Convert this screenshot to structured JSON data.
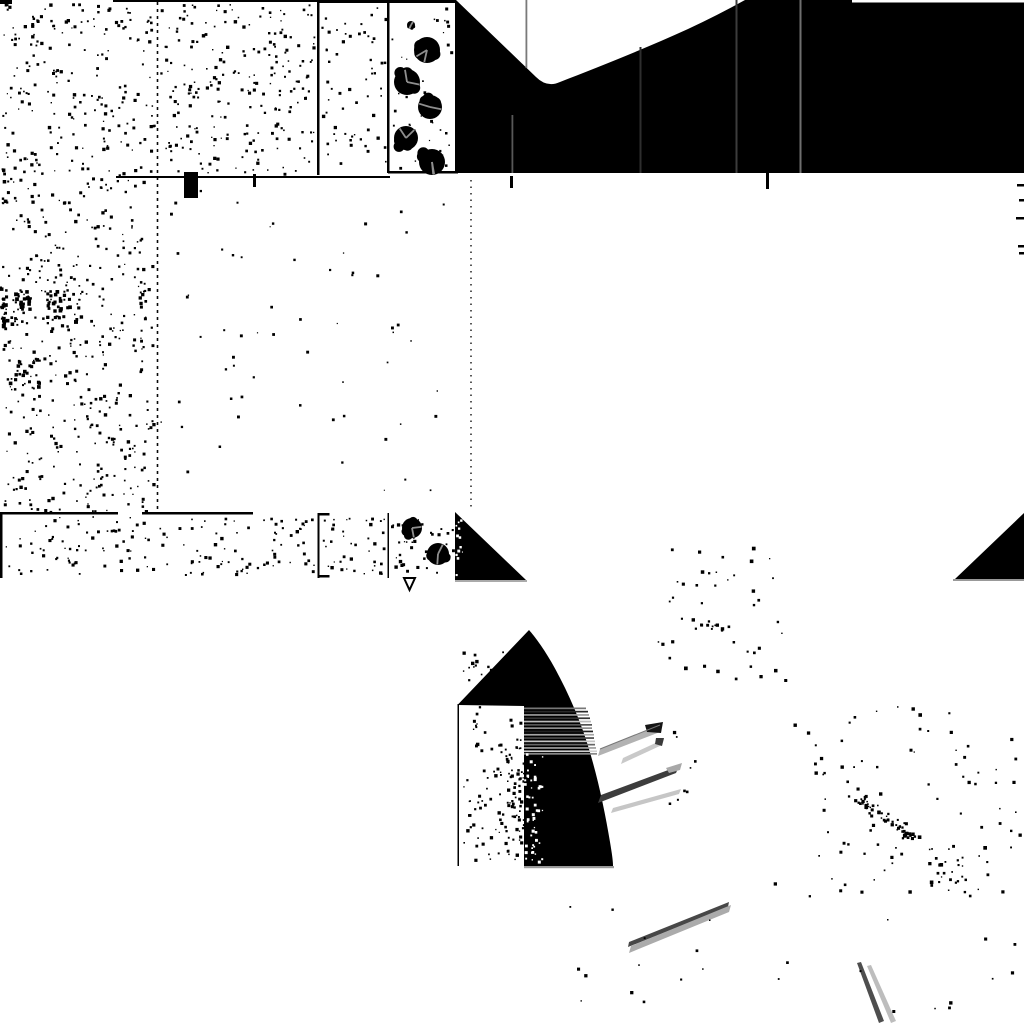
{
  "meta": {
    "width": 1024,
    "height": 1024,
    "viewBox": "0 0 1024 1024",
    "background": "#ffffff",
    "ink": "#000000"
  },
  "figure": {
    "elements": [
      {
        "type": "noise",
        "name": "field-a-speckle",
        "x": 2,
        "y": 3,
        "w": 152,
        "h": 508,
        "n": 620,
        "size": 2.2,
        "seed": 11
      },
      {
        "type": "noise",
        "name": "field-a-cluster-1",
        "x": 0,
        "y": 288,
        "w": 30,
        "h": 36,
        "n": 42,
        "size": 2.6,
        "seed": 12
      },
      {
        "type": "noise",
        "name": "field-a-cluster-2",
        "x": 46,
        "y": 290,
        "w": 34,
        "h": 30,
        "n": 36,
        "size": 2.6,
        "seed": 13
      },
      {
        "type": "noise",
        "name": "field-a-cluster-3",
        "x": 8,
        "y": 358,
        "w": 32,
        "h": 32,
        "n": 28,
        "size": 2.4,
        "seed": 14
      },
      {
        "type": "noise",
        "name": "field-b-speckle",
        "x": 160,
        "y": 3,
        "w": 154,
        "h": 170,
        "n": 225,
        "size": 2.2,
        "seed": 15
      },
      {
        "type": "noise",
        "name": "field-c-speckle",
        "x": 321,
        "y": 3,
        "w": 64,
        "h": 168,
        "n": 60,
        "size": 2.2,
        "seed": 16
      },
      {
        "type": "noise",
        "name": "tree-column-speckle",
        "x": 391,
        "y": 5,
        "w": 60,
        "h": 164,
        "n": 45,
        "size": 2.0,
        "seed": 17
      },
      {
        "type": "noise",
        "name": "mid-sparse-speckle",
        "x": 160,
        "y": 182,
        "w": 292,
        "h": 326,
        "n": 60,
        "size": 2.0,
        "seed": 18
      },
      {
        "type": "noise",
        "name": "strip-field-1-speckle",
        "x": 4,
        "y": 516,
        "w": 310,
        "h": 58,
        "n": 150,
        "size": 2.2,
        "seed": 19
      },
      {
        "type": "noise",
        "name": "strip-field-2-speckle",
        "x": 322,
        "y": 516,
        "w": 62,
        "h": 58,
        "n": 40,
        "size": 2.2,
        "seed": 20
      },
      {
        "type": "noise",
        "name": "strip-field-3-speckle",
        "x": 390,
        "y": 516,
        "w": 62,
        "h": 58,
        "n": 38,
        "size": 2.2,
        "seed": 21
      },
      {
        "type": "noise",
        "name": "left-edge-marks-1",
        "x": 0,
        "y": 168,
        "w": 4,
        "h": 36,
        "n": 10,
        "size": 2.4,
        "seed": 22
      },
      {
        "type": "noise",
        "name": "left-edge-marks-2",
        "x": 0,
        "y": 283,
        "w": 5,
        "h": 48,
        "n": 16,
        "size": 2.6,
        "seed": 23
      },
      {
        "type": "line",
        "name": "field-boundary-dashed-157",
        "x1": 157.5,
        "y1": 2,
        "x2": 157.5,
        "y2": 512,
        "stroke": "#0a0a0a",
        "width": 1.6,
        "dash": "3 4"
      },
      {
        "type": "line",
        "name": "dotted-boundary-471",
        "x1": 471,
        "y1": 180,
        "x2": 471,
        "y2": 511,
        "stroke": "#111111",
        "width": 1.4,
        "dash": "1.5 5"
      },
      {
        "type": "rect",
        "name": "top-border-segment-1",
        "x": 0,
        "y": 0,
        "w": 12,
        "h": 4,
        "fill": "#000000"
      },
      {
        "type": "rect",
        "name": "top-border-segment-2",
        "x": 113,
        "y": 0,
        "w": 205,
        "h": 2,
        "fill": "#000000"
      },
      {
        "type": "rect",
        "name": "top-border-segment-3",
        "x": 318,
        "y": 0,
        "w": 137,
        "h": 3,
        "fill": "#000000"
      },
      {
        "type": "rect",
        "name": "field-border-317",
        "x": 317,
        "y": 0,
        "w": 2.5,
        "h": 175,
        "fill": "#000000"
      },
      {
        "type": "rect",
        "name": "field-border-387",
        "x": 387,
        "y": 0,
        "w": 2.5,
        "h": 173,
        "fill": "#000000"
      },
      {
        "type": "rect",
        "name": "boundary-line-y177",
        "x": 116,
        "y": 176,
        "w": 274,
        "h": 2,
        "fill": "#000000"
      },
      {
        "type": "rect",
        "name": "boundary-line-y172",
        "x": 388,
        "y": 171,
        "w": 70,
        "h": 2.5,
        "fill": "#000000"
      },
      {
        "type": "rect",
        "name": "square-blob",
        "x": 184,
        "y": 172,
        "w": 14,
        "h": 26,
        "fill": "#000000"
      },
      {
        "type": "rect",
        "name": "tick-x254",
        "x": 253,
        "y": 174,
        "w": 3,
        "h": 13,
        "fill": "#000000"
      },
      {
        "type": "rect",
        "name": "tick-x511",
        "x": 510,
        "y": 176,
        "w": 3,
        "h": 12,
        "fill": "#000000"
      },
      {
        "type": "rect",
        "name": "tick-x767",
        "x": 766,
        "y": 173,
        "w": 3,
        "h": 16,
        "fill": "#000000"
      },
      {
        "type": "rect",
        "name": "black-sky-region",
        "x": 455,
        "y": 0,
        "w": 569,
        "h": 173,
        "fill": "#000000"
      },
      {
        "type": "path",
        "name": "valley-cutout",
        "d": "M456,0 L536,77 Q547,88 560,82 C596,68 642,50 688,29 Q718,15 745,0 Z",
        "fill": "#ffffff"
      },
      {
        "type": "rect",
        "name": "top-right-white-sliver",
        "x": 852,
        "y": 0,
        "w": 172,
        "h": 2.5,
        "fill": "#ffffff"
      },
      {
        "type": "rect",
        "name": "gray-vline-512",
        "x": 511.5,
        "y": 115,
        "w": 1.8,
        "h": 58,
        "fill": "#585858"
      },
      {
        "type": "rect",
        "name": "gray-vline-526",
        "x": 525.5,
        "y": 0,
        "w": 1.8,
        "h": 68,
        "fill": "#7a7a7a"
      },
      {
        "type": "rect",
        "name": "gray-vline-640",
        "x": 639.5,
        "y": 47,
        "w": 2,
        "h": 126,
        "fill": "#2e2e2e"
      },
      {
        "type": "rect",
        "name": "gray-vline-736",
        "x": 735.5,
        "y": 0,
        "w": 2,
        "h": 173,
        "fill": "#3c3c3c"
      },
      {
        "type": "rect",
        "name": "gray-vline-800",
        "x": 799.5,
        "y": 0,
        "w": 2,
        "h": 173,
        "fill": "#6f6f6f"
      },
      {
        "type": "tree",
        "name": "tree-top-1",
        "cx": 427,
        "cy": 50,
        "r": 13,
        "seed": 31
      },
      {
        "type": "tree",
        "name": "tree-top-2",
        "cx": 407,
        "cy": 82,
        "r": 13,
        "seed": 32
      },
      {
        "type": "tree",
        "name": "tree-top-3",
        "cx": 430,
        "cy": 107,
        "r": 12,
        "seed": 33
      },
      {
        "type": "tree",
        "name": "tree-top-4",
        "cx": 406,
        "cy": 138,
        "r": 12,
        "seed": 34
      },
      {
        "type": "tree",
        "name": "tree-top-5",
        "cx": 432,
        "cy": 162,
        "r": 13,
        "seed": 35
      },
      {
        "type": "tree",
        "name": "tree-top-sapling",
        "cx": 411,
        "cy": 25,
        "r": 4,
        "seed": 36
      },
      {
        "type": "rect",
        "name": "strip-left-border",
        "x": 0,
        "y": 513,
        "w": 2.5,
        "h": 65,
        "fill": "#000000"
      },
      {
        "type": "rect",
        "name": "strip-top-line-a",
        "x": 0,
        "y": 512,
        "w": 118,
        "h": 2.5,
        "fill": "#000000"
      },
      {
        "type": "rect",
        "name": "strip-top-line-b",
        "x": 142,
        "y": 512,
        "w": 111,
        "h": 2.5,
        "fill": "#000000"
      },
      {
        "type": "rect",
        "name": "strip-bracket-318",
        "x": 317.5,
        "y": 513,
        "w": 2,
        "h": 65,
        "fill": "#000000"
      },
      {
        "type": "rect",
        "name": "strip-bracket-318-top-serif",
        "x": 317.5,
        "y": 513,
        "w": 12,
        "h": 2.5,
        "fill": "#000000"
      },
      {
        "type": "rect",
        "name": "strip-bracket-318-bottom-serif",
        "x": 317.5,
        "y": 575,
        "w": 12,
        "h": 2.5,
        "fill": "#000000"
      },
      {
        "type": "rect",
        "name": "strip-border-388",
        "x": 387.5,
        "y": 513,
        "w": 1.5,
        "h": 65,
        "fill": "#000000"
      },
      {
        "type": "tree",
        "name": "tree-strip-1",
        "cx": 412,
        "cy": 528,
        "r": 10,
        "seed": 37
      },
      {
        "type": "tree",
        "name": "tree-strip-2",
        "cx": 438,
        "cy": 554,
        "r": 11,
        "seed": 38
      },
      {
        "type": "path",
        "name": "strip-triangle-left",
        "d": "M455,512 L526,580 L455,580 Z",
        "fill": "#000000"
      },
      {
        "type": "rect",
        "name": "strip-triangle-left-underline",
        "x": 455,
        "y": 580,
        "w": 72,
        "h": 2,
        "fill": "#aaaaaa"
      },
      {
        "type": "noise",
        "name": "strip-triangle-left-white-specks",
        "x": 455,
        "y": 516,
        "w": 7,
        "h": 58,
        "n": 12,
        "size": 2.0,
        "fill": "#ffffff",
        "seed": 24
      },
      {
        "type": "path",
        "name": "strip-triangle-right",
        "d": "M1024,513 L1024,579 L955,579 Z",
        "fill": "#000000"
      },
      {
        "type": "rect",
        "name": "strip-triangle-right-underline",
        "x": 953,
        "y": 579,
        "w": 71,
        "h": 2,
        "fill": "#999999"
      },
      {
        "type": "path",
        "name": "nabla-marker",
        "d": "M404,578 L415,578 L409.5,590 Z",
        "fill": "#ffffff",
        "stroke": "#000000",
        "strokeWidth": 2
      },
      {
        "type": "noise",
        "name": "tower-left-specks",
        "x": 462,
        "y": 648,
        "w": 58,
        "h": 212,
        "n": 110,
        "size": 2.2,
        "seed": 25
      },
      {
        "type": "noise",
        "name": "tower-left-specks-dense",
        "x": 504,
        "y": 738,
        "w": 20,
        "h": 124,
        "n": 55,
        "size": 2.2,
        "seed": 26
      },
      {
        "type": "noise",
        "name": "tower-apex-edge-specks",
        "x": 514,
        "y": 640,
        "w": 14,
        "h": 64,
        "n": 20,
        "size": 2.2,
        "seed": 27
      },
      {
        "type": "path",
        "name": "tower-silhouette",
        "d": "M457.5,705 L529,630 C537,639 549,656 560,678 C574,705 585,733 593,763 C600,788 606,818 610,842 C612,854 613,861 613,866 L524,866 L524,706 Z",
        "fill": "#000000"
      },
      {
        "type": "rect",
        "name": "tower-left-vline",
        "x": 457.5,
        "y": 704,
        "w": 1.5,
        "h": 162,
        "fill": "#000000"
      },
      {
        "type": "rect",
        "name": "tower-scanline-1",
        "x": 524,
        "y": 707.5,
        "w": 62,
        "h": 1.7,
        "fill": "#777777"
      },
      {
        "type": "rect",
        "name": "tower-scanline-2",
        "x": 524,
        "y": 710.8,
        "w": 64,
        "h": 1.7,
        "fill": "#2a2a2a"
      },
      {
        "type": "rect",
        "name": "tower-scanline-3",
        "x": 524,
        "y": 714.1,
        "w": 65,
        "h": 1.7,
        "fill": "#999999"
      },
      {
        "type": "rect",
        "name": "tower-scanline-4",
        "x": 524,
        "y": 717.4,
        "w": 66,
        "h": 1.7,
        "fill": "#333333"
      },
      {
        "type": "rect",
        "name": "tower-scanline-5",
        "x": 524,
        "y": 720.7,
        "w": 67,
        "h": 1.7,
        "fill": "#bbbbbb"
      },
      {
        "type": "rect",
        "name": "tower-scanline-6",
        "x": 524,
        "y": 724.0,
        "w": 68,
        "h": 1.7,
        "fill": "#555555"
      },
      {
        "type": "rect",
        "name": "tower-scanline-7",
        "x": 524,
        "y": 727.3,
        "w": 68,
        "h": 1.7,
        "fill": "#8d8d8d"
      },
      {
        "type": "rect",
        "name": "tower-scanline-8",
        "x": 524,
        "y": 730.6,
        "w": 69,
        "h": 1.7,
        "fill": "#222222"
      },
      {
        "type": "rect",
        "name": "tower-scanline-9",
        "x": 524,
        "y": 733.9,
        "w": 70,
        "h": 1.7,
        "fill": "#a5a5a5"
      },
      {
        "type": "rect",
        "name": "tower-scanline-10",
        "x": 524,
        "y": 737.2,
        "w": 70,
        "h": 1.7,
        "fill": "#4a4a4a"
      },
      {
        "type": "rect",
        "name": "tower-scanline-11",
        "x": 524,
        "y": 740.5,
        "w": 71,
        "h": 1.7,
        "fill": "#c4c4c4"
      },
      {
        "type": "rect",
        "name": "tower-scanline-12",
        "x": 524,
        "y": 743.8,
        "w": 71,
        "h": 1.7,
        "fill": "#666666"
      },
      {
        "type": "rect",
        "name": "tower-scanline-13",
        "x": 524,
        "y": 747.1,
        "w": 72,
        "h": 1.7,
        "fill": "#9e9e9e"
      },
      {
        "type": "rect",
        "name": "tower-scanline-14",
        "x": 524,
        "y": 750.4,
        "w": 73,
        "h": 1.7,
        "fill": "#d0d0d0"
      },
      {
        "type": "rect",
        "name": "tower-scanline-15",
        "x": 524,
        "y": 753.0,
        "w": 73,
        "h": 1.7,
        "fill": "#888888"
      },
      {
        "type": "noise",
        "name": "tower-white-specks",
        "x": 524,
        "y": 752,
        "w": 18,
        "h": 112,
        "n": 48,
        "size": 2.0,
        "fill": "#ffffff",
        "seed": 28
      },
      {
        "type": "rect",
        "name": "tower-underline",
        "x": 524,
        "y": 866,
        "w": 90,
        "h": 2.2,
        "fill": "#9a9a9a"
      },
      {
        "type": "path",
        "name": "streak-a-band",
        "d": "M598,756 L600,749 L662,724 L660,732 Z",
        "fill": "#b2b2b2"
      },
      {
        "type": "path",
        "name": "streak-a-tip",
        "d": "M645,725 L663,722 L661,733 L647,732 Z",
        "fill": "#151515"
      },
      {
        "type": "line",
        "name": "streak-a-edge",
        "x1": 600,
        "y1": 749,
        "x2": 660,
        "y2": 725,
        "stroke": "#777777",
        "width": 1
      },
      {
        "type": "path",
        "name": "streak-b-band",
        "d": "M621,764 L623,758 L664,739 L662,745 Z",
        "fill": "#c9c9c9"
      },
      {
        "type": "path",
        "name": "streak-b-tip",
        "d": "M656,738 L664,738 L662,746 L655,744 Z",
        "fill": "#3a3a3a"
      },
      {
        "type": "path",
        "name": "streak-c-band",
        "d": "M598,803 L601,795 L679,766 L676,773 Z",
        "fill": "#3d3d3d"
      },
      {
        "type": "path",
        "name": "streak-c-tail",
        "d": "M666,768 L682,763 L680,770 L669,773 Z",
        "fill": "#a8a8a8"
      },
      {
        "type": "path",
        "name": "streak-d-band",
        "d": "M611,813 L613,808 L681,789 L679,794 Z",
        "fill": "#c6c6c6"
      },
      {
        "type": "path",
        "name": "streak-e-dark",
        "d": "M628,947 L629,942 L729,902 L728,907 Z",
        "fill": "#474747"
      },
      {
        "type": "path",
        "name": "streak-e-light",
        "d": "M629,953 L631,946 L731,905 L729,912 Z",
        "fill": "#ababab"
      },
      {
        "type": "path",
        "name": "streak-f-dark",
        "d": "M857,963 L861,962 L884,1021 L879,1023 Z",
        "fill": "#4e4e4e"
      },
      {
        "type": "path",
        "name": "streak-f-light",
        "d": "M867,966 L871,965 L896,1021 L891,1023 Z",
        "fill": "#bdbdbd"
      },
      {
        "type": "noise",
        "name": "streak-area-dots",
        "x": 665,
        "y": 715,
        "w": 40,
        "h": 90,
        "n": 8,
        "size": 2.2,
        "seed": 29
      },
      {
        "type": "noise",
        "name": "cluster-mid-speckle",
        "x": 655,
        "y": 545,
        "w": 132,
        "h": 148,
        "n": 45,
        "size": 2.4,
        "seed": 41
      },
      {
        "type": "chain",
        "name": "cluster-mid-chain",
        "x1": 688,
        "y1": 618,
        "x2": 728,
        "y2": 628,
        "spread": 4,
        "n": 10,
        "size": 2.4,
        "seed": 42
      },
      {
        "type": "noise",
        "name": "cluster-right-speckle",
        "x": 790,
        "y": 706,
        "w": 214,
        "h": 192,
        "n": 80,
        "size": 2.4,
        "seed": 43
      },
      {
        "type": "chain",
        "name": "cluster-right-chain",
        "x1": 856,
        "y1": 796,
        "x2": 914,
        "y2": 838,
        "spread": 5,
        "n": 55,
        "size": 2.5,
        "seed": 44
      },
      {
        "type": "noise",
        "name": "cluster-right-sub",
        "x": 928,
        "y": 840,
        "w": 38,
        "h": 46,
        "n": 20,
        "size": 2.4,
        "seed": 45
      },
      {
        "type": "noise",
        "name": "scattered-bottom-dots",
        "x": 560,
        "y": 882,
        "w": 450,
        "h": 128,
        "n": 26,
        "size": 2.2,
        "seed": 46
      },
      {
        "type": "noise",
        "name": "right-edge-sparse-dots",
        "x": 988,
        "y": 690,
        "w": 34,
        "h": 290,
        "n": 12,
        "size": 2.2,
        "seed": 47
      },
      {
        "type": "rect",
        "name": "right-edge-tick-1",
        "x": 1017,
        "y": 184,
        "w": 7,
        "h": 2.5,
        "fill": "#000000"
      },
      {
        "type": "rect",
        "name": "right-edge-tick-2",
        "x": 1019,
        "y": 199,
        "w": 5,
        "h": 2.5,
        "fill": "#000000"
      },
      {
        "type": "rect",
        "name": "right-edge-tick-3",
        "x": 1016,
        "y": 217,
        "w": 8,
        "h": 2.5,
        "fill": "#000000"
      },
      {
        "type": "rect",
        "name": "right-edge-tick-4",
        "x": 1018,
        "y": 245,
        "w": 6,
        "h": 2.5,
        "fill": "#000000"
      },
      {
        "type": "rect",
        "name": "right-edge-tick-5",
        "x": 1019,
        "y": 252,
        "w": 5,
        "h": 2.5,
        "fill": "#000000"
      }
    ]
  }
}
